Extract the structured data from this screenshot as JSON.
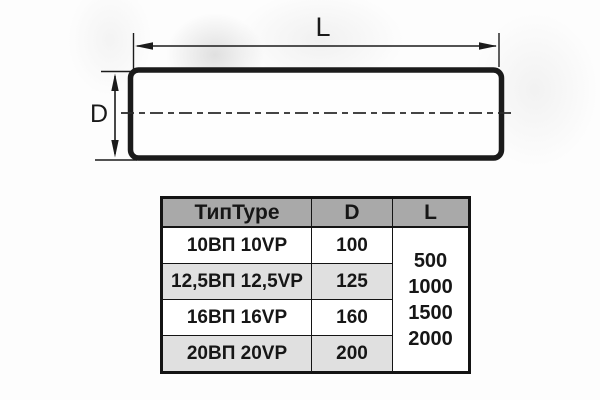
{
  "diagram": {
    "length_label": "L",
    "diameter_label": "D"
  },
  "table": {
    "headers": {
      "type": "ТипType",
      "d": "D",
      "l": "L"
    },
    "rows": [
      {
        "type": "10ВП 10VP",
        "d": "100"
      },
      {
        "type": "12,5ВП 12,5VP",
        "d": "125"
      },
      {
        "type": "16ВП 16VP",
        "d": "160"
      },
      {
        "type": "20ВП 20VP",
        "d": "200"
      }
    ],
    "l_values": [
      "500",
      "1000",
      "1500",
      "2000"
    ]
  },
  "colors": {
    "line": "#1b1b1b",
    "table_border": "#141414",
    "header_bg": "#a9a9a9",
    "row_bg": "#ffffff",
    "row_alt_bg": "#e0e0e0",
    "text": "#161616"
  }
}
